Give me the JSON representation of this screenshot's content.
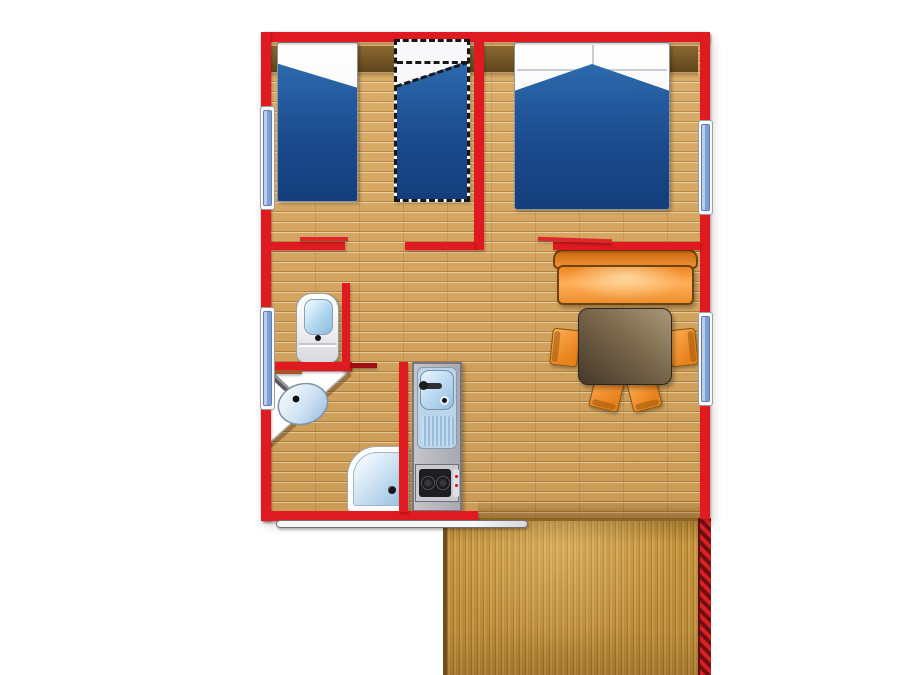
{
  "canvas": {
    "width": 900,
    "height": 675,
    "background": "#ffffff"
  },
  "colors": {
    "wall_red": "#DF1A20",
    "door_leaf_red": "#E0252B",
    "floor_tan": "#D6A45A",
    "headboard_brown": "#6E5222",
    "bed_blue": "#1B4B8E",
    "bed_linen_white": "#FAFAFC",
    "window_blue": "#7E9FD6",
    "sofa_orange": "#F08522",
    "chair_orange": "#F39C3E",
    "table_brown": "#6B5941",
    "fixture_white": "#FFFFFF",
    "fixture_glass_blue": "#AFD6EE",
    "kitchen_gray": "#B6B6BE",
    "hob_black": "#1E1E22",
    "deck_wood": "#C4943F",
    "railing_red": "#DA1F25"
  },
  "labels": {
    "plan": "mobile-home-floor-plan",
    "bedroom_left": "bedroom-with-two-single-beds",
    "bedroom_right": "bedroom-with-double-bed",
    "single_bed": "single-bed",
    "spare_bed": "optional-fold-out-bed (dashed)",
    "double_bed": "double-bed",
    "sofa": "sofa",
    "table": "dining-table",
    "chair": "chair",
    "toilet": "toilet",
    "washbasin": "corner-washbasin",
    "shower": "shower-tray",
    "kitchen": "kitchenette-block",
    "sink": "kitchen-sink",
    "hob": "two-burner-hob",
    "terrace": "wooden-terrace-deck",
    "railing": "terrace-railing",
    "window": "window",
    "door": "door-leaf",
    "patio_door": "sliding-patio-door"
  },
  "rooms": [
    {
      "id": "bedroom-left",
      "furniture": [
        "single-bed",
        "optional-fold-out-bed"
      ]
    },
    {
      "id": "bedroom-right",
      "furniture": [
        "double-bed"
      ]
    },
    {
      "id": "wc",
      "furniture": [
        "toilet"
      ]
    },
    {
      "id": "bathroom",
      "furniture": [
        "corner-washbasin",
        "shower"
      ]
    },
    {
      "id": "kitchen-living",
      "furniture": [
        "kitchenette",
        "sofa",
        "dining-table",
        "chair",
        "chair",
        "chair",
        "chair"
      ]
    },
    {
      "id": "terrace",
      "furniture": []
    }
  ],
  "counts": {
    "windows": 4,
    "chairs": 4,
    "beds": 3,
    "burners": 2
  }
}
